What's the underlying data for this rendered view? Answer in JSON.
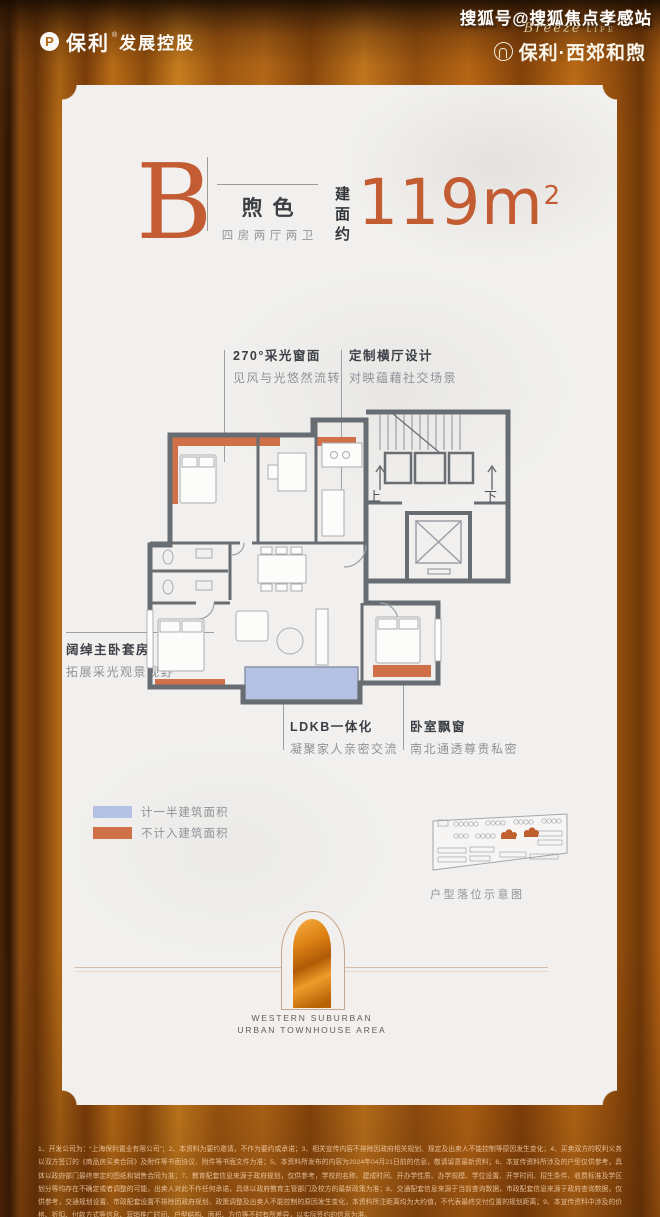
{
  "watermark": {
    "text": "搜狐号@搜狐焦点孝感站"
  },
  "header": {
    "brand_left": {
      "icon": "poly-circle-P",
      "name": "保利",
      "reg": "®",
      "suffix": "发展控股"
    },
    "brand_right": {
      "script": "Breeze",
      "script_suffix": "LIFE",
      "name": "保利·西郊和煦"
    }
  },
  "card": {
    "unit": {
      "letter": "B",
      "name": "煦色",
      "layout": "四房两厅两卫",
      "area_prefix": "建面约",
      "area_value": "119m",
      "area_sup": "2"
    },
    "annotations": [
      {
        "title": "270°采光窗面",
        "desc": "见风与光悠然流转"
      },
      {
        "title": "定制横厅设计",
        "desc": "对映蕴藉社交场景"
      },
      {
        "title": "阔绰主卧套房",
        "desc": "拓展采光观景视野"
      },
      {
        "title": "LDKB一体化",
        "desc": "凝聚家人亲密交流"
      },
      {
        "title": "卧室飘窗",
        "desc": "南北通透尊贵私密"
      }
    ],
    "plan": {
      "up_label": "上",
      "down_label": "下"
    },
    "legend": [
      {
        "color": "#b5c1e3",
        "label": "计一半建筑面积"
      },
      {
        "color": "#cf7049",
        "label": "不计入建筑面积"
      }
    ],
    "siteplan_caption": "户型落位示意图",
    "emblem": {
      "line1": "WESTERN SUBURBAN",
      "line2": "URBAN TOWNHOUSE AREA"
    }
  },
  "colors": {
    "accent_orange": "#c35c33",
    "wall_gray": "#686d73",
    "balcony_blue": "#b5c1e3",
    "window_strip_orange": "#cf7049",
    "background_amber": "#c87618"
  },
  "footer": {
    "disclaimer": "1、开发公司为：“上海保利置业有限公司”；2、本资料为要约邀请，不作为要约或承诺；3、相关宣传内容不排除因政府相关规划、规定及出卖人不能控制等原因发生变化；4、买卖双方的权利义务以双方签订的《商品房买卖合同》及附件等书面协议、附件等书面文件为准；5、本资料所发布的内容为2024年04月21日前的信息，敬请留意最新资料；6、本宣传资料所涉及的户型仅供参考，具体以政府部门最终审定的图纸和销售合同为准；7、教育配套信息来源于政府规划，仅供参考，学校的名称、建成时间、开办学性质、办学规模、学位设置、开学时间、招生条件、收费标准及学区划分等均存在不确定或者调整的可能，出卖人对此不作任何承诺，具体以政府教育主管部门及校方的最新政策为准；8、交通配套信息来源于当前查询数据，市政配套信息来源于政府查询数据，仅供参考，交通规划设置、市政配套设置不排除因政府规划、政策调整及出卖人不能控制的原因发生变化，本资料所注距离均为大约值，不代表最终交付位置的规划距离；9、本宣传资料中涉及的价格、折扣、付款方式等信息、营销推广时间、户型结构、面积、方位等不时有所差异，以实际签约的信息为准。"
  }
}
